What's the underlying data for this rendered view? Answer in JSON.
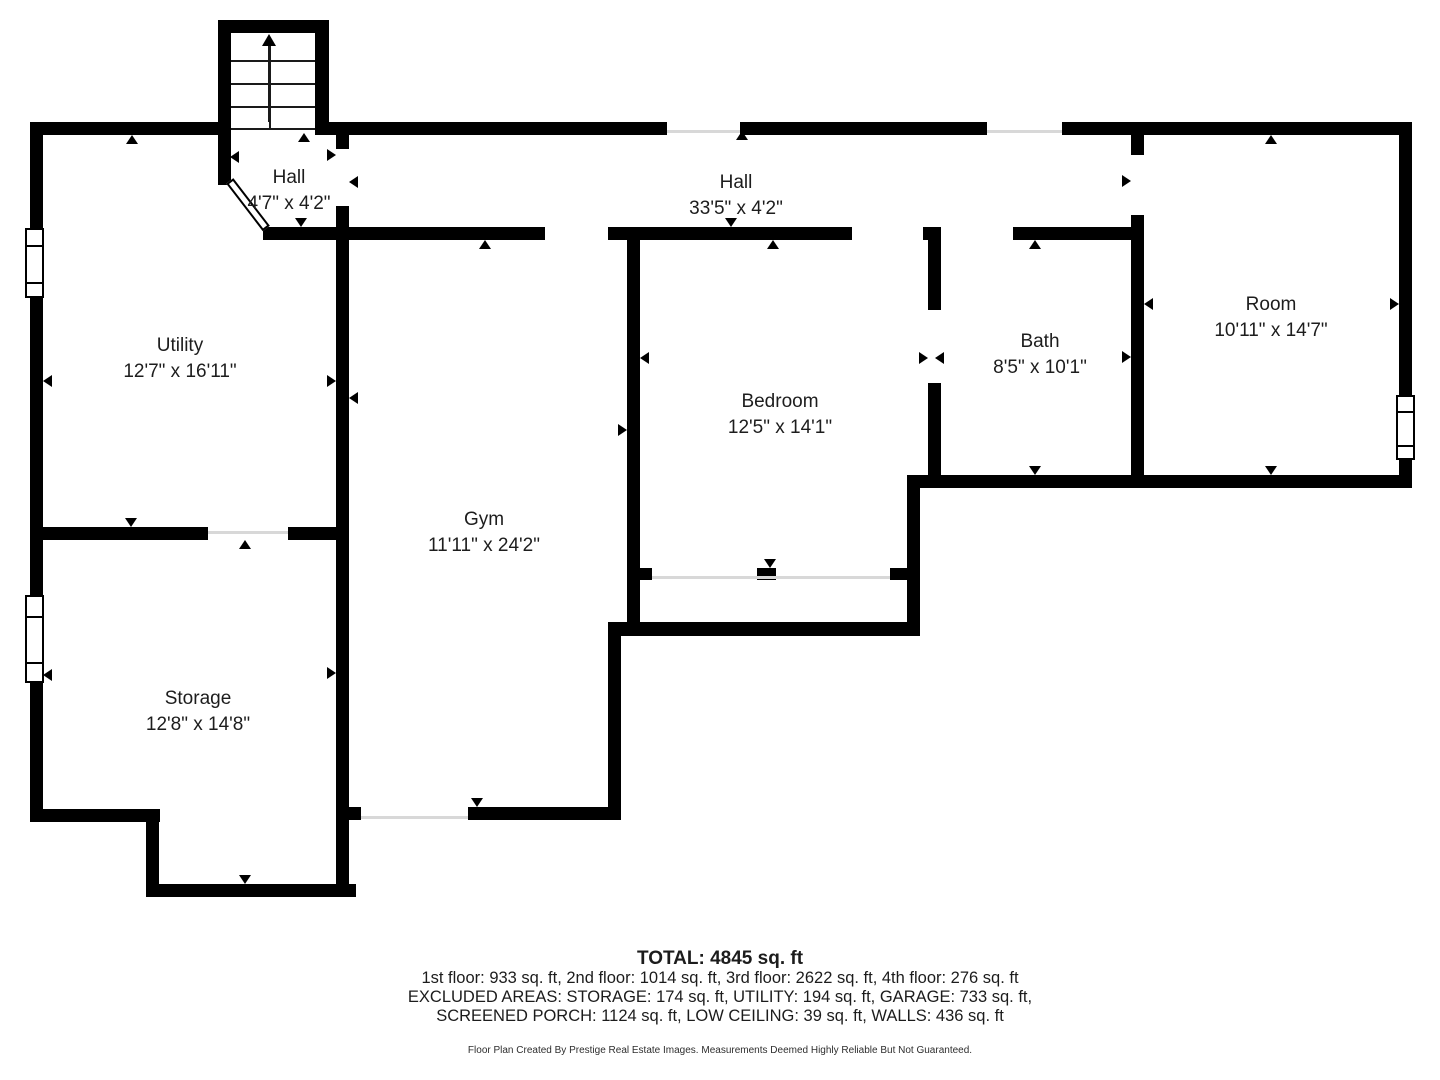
{
  "rooms": [
    {
      "id": "hall-small",
      "label": "Hall",
      "dims": "4'7\" x 4'2\"",
      "cx": 289,
      "cy": 191
    },
    {
      "id": "hall",
      "label": "Hall",
      "dims": "33'5\" x 4'2\"",
      "cx": 736,
      "cy": 196
    },
    {
      "id": "utility",
      "label": "Utility",
      "dims": "12'7\" x 16'11\"",
      "cx": 180,
      "cy": 359
    },
    {
      "id": "room",
      "label": "Room",
      "dims": "10'11\" x 14'7\"",
      "cx": 1271,
      "cy": 318
    },
    {
      "id": "bath",
      "label": "Bath",
      "dims": "8'5\" x 10'1\"",
      "cx": 1040,
      "cy": 355
    },
    {
      "id": "bedroom",
      "label": "Bedroom",
      "dims": "12'5\" x 14'1\"",
      "cx": 780,
      "cy": 415
    },
    {
      "id": "gym",
      "label": "Gym",
      "dims": "11'11\" x 24'2\"",
      "cx": 484,
      "cy": 533
    },
    {
      "id": "storage",
      "label": "Storage",
      "dims": "12'8\" x 14'8\"",
      "cx": 198,
      "cy": 712
    }
  ],
  "footer": {
    "total": "TOTAL: 4845 sq. ft",
    "line1": "1st floor: 933 sq. ft, 2nd floor: 1014 sq. ft, 3rd floor: 2622 sq. ft, 4th floor: 276 sq. ft",
    "line2": "EXCLUDED AREAS: STORAGE: 174 sq. ft, UTILITY: 194 sq. ft, GARAGE: 733 sq. ft,",
    "line3": "SCREENED PORCH: 1124 sq. ft, LOW CEILING: 39 sq. ft, WALLS: 436 sq. ft",
    "credit": "Floor Plan Created By Prestige Real Estate Images. Measurements Deemed Highly Reliable But Not Guaranteed."
  },
  "colors": {
    "wall": "#000000",
    "background": "#ffffff",
    "text": "#1d1d1d",
    "opening_line": "#d8d8d8"
  },
  "floorplan": {
    "walls": [
      [
        218,
        20,
        13,
        165
      ],
      [
        218,
        20,
        103,
        13
      ],
      [
        315,
        20,
        14,
        115
      ],
      [
        30,
        122,
        188,
        13
      ],
      [
        315,
        122,
        352,
        13
      ],
      [
        740,
        122,
        247,
        13
      ],
      [
        1062,
        122,
        350,
        13
      ],
      [
        30,
        122,
        13,
        106
      ],
      [
        30,
        298,
        13,
        229
      ],
      [
        30,
        540,
        13,
        55
      ],
      [
        30,
        683,
        13,
        139
      ],
      [
        30,
        809,
        130,
        13
      ],
      [
        146,
        809,
        13,
        88
      ],
      [
        146,
        884,
        210,
        13
      ],
      [
        30,
        527,
        178,
        13
      ],
      [
        288,
        527,
        58,
        13
      ],
      [
        336,
        135,
        13,
        14
      ],
      [
        336,
        206,
        13,
        24
      ],
      [
        336,
        230,
        13,
        667
      ],
      [
        263,
        227,
        85,
        13
      ],
      [
        346,
        227,
        199,
        13
      ],
      [
        608,
        227,
        244,
        13
      ],
      [
        923,
        227,
        18,
        13
      ],
      [
        1013,
        227,
        118,
        13
      ],
      [
        928,
        227,
        13,
        83
      ],
      [
        928,
        383,
        13,
        94
      ],
      [
        1131,
        122,
        13,
        33
      ],
      [
        1131,
        215,
        13,
        262
      ],
      [
        1399,
        122,
        13,
        273
      ],
      [
        1399,
        460,
        13,
        28
      ],
      [
        910,
        475,
        502,
        13
      ],
      [
        907,
        475,
        13,
        161
      ],
      [
        608,
        622,
        312,
        14
      ],
      [
        608,
        622,
        13,
        198
      ],
      [
        346,
        807,
        15,
        13
      ],
      [
        468,
        807,
        153,
        13
      ],
      [
        627,
        227,
        13,
        409
      ],
      [
        640,
        568,
        12,
        12
      ],
      [
        757,
        568,
        19,
        12
      ],
      [
        890,
        568,
        17,
        12
      ]
    ],
    "windows": [
      {
        "rect": [
          25,
          228,
          19,
          70
        ],
        "name": "utility-window"
      },
      {
        "rect": [
          25,
          595,
          19,
          88
        ],
        "name": "storage-window"
      },
      {
        "rect": [
          1396,
          395,
          19,
          65
        ],
        "name": "room-window"
      }
    ],
    "openings": [
      [
        667,
        130,
        73,
        3
      ],
      [
        987,
        130,
        75,
        3
      ],
      [
        208,
        531,
        80,
        3
      ],
      [
        361,
        816,
        107,
        3
      ],
      [
        652,
        576,
        238,
        3
      ]
    ],
    "arrows": [
      [
        132,
        135,
        "up"
      ],
      [
        43,
        381,
        "left"
      ],
      [
        131,
        527,
        "down"
      ],
      [
        336,
        381,
        "right"
      ],
      [
        245,
        540,
        "up"
      ],
      [
        43,
        675,
        "left"
      ],
      [
        245,
        884,
        "down"
      ],
      [
        336,
        673,
        "right"
      ],
      [
        304,
        133,
        "up"
      ],
      [
        230,
        157,
        "left"
      ],
      [
        336,
        155,
        "right"
      ],
      [
        349,
        182,
        "left"
      ],
      [
        301,
        227,
        "down"
      ],
      [
        263,
        233,
        "left"
      ],
      [
        742,
        131,
        "up"
      ],
      [
        731,
        227,
        "down"
      ],
      [
        485,
        240,
        "up"
      ],
      [
        349,
        398,
        "left"
      ],
      [
        627,
        430,
        "right"
      ],
      [
        477,
        807,
        "down"
      ],
      [
        773,
        240,
        "up"
      ],
      [
        640,
        358,
        "left"
      ],
      [
        770,
        568,
        "down"
      ],
      [
        1035,
        240,
        "up"
      ],
      [
        928,
        358,
        "right"
      ],
      [
        935,
        358,
        "left"
      ],
      [
        1035,
        475,
        "down"
      ],
      [
        1131,
        357,
        "right"
      ],
      [
        1131,
        181,
        "right"
      ],
      [
        1271,
        135,
        "up"
      ],
      [
        1399,
        304,
        "right"
      ],
      [
        1271,
        475,
        "down"
      ],
      [
        1144,
        304,
        "left"
      ]
    ],
    "stairs": {
      "treads_y": [
        60,
        83,
        106,
        128
      ],
      "tread_x": 231,
      "tread_w": 84,
      "center_line": [
        269,
        60,
        2,
        70
      ],
      "arrow_shaft": [
        268,
        44,
        3,
        78
      ],
      "arrow_head_tip": [
        269,
        34
      ]
    },
    "door_diagonal": {
      "left": 227,
      "top": 182,
      "width": 9,
      "height": 60
    }
  }
}
